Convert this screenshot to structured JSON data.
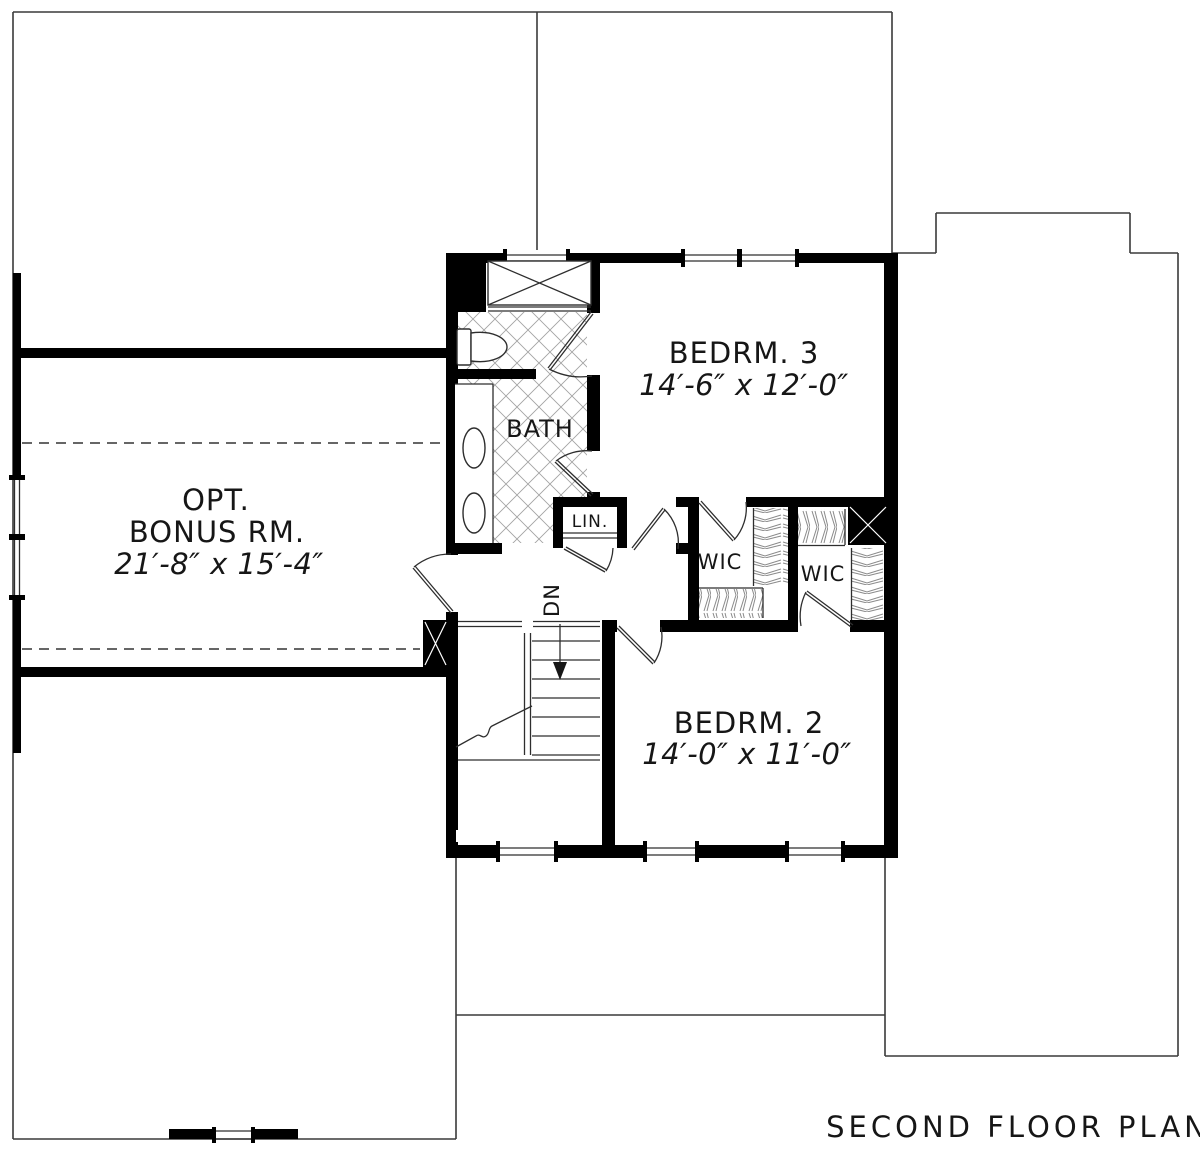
{
  "plan_title": "SECOND FLOOR PLAN",
  "rooms": {
    "bonus": {
      "line1": "OPT.",
      "line2": "BONUS RM.",
      "dims": "21′-8″ x 15′-4″"
    },
    "bedroom3": {
      "name": "BEDRM. 3",
      "dims": "14′-6″ x 12′-0″"
    },
    "bedroom2": {
      "name": "BEDRM. 2",
      "dims": "14′-0″ x 11′-0″"
    },
    "bath": {
      "name": "BATH"
    },
    "linen": {
      "name": "LIN."
    },
    "wic_bedroom3": {
      "name": "WIC"
    },
    "wic_bedroom2": {
      "name": "WIC"
    },
    "stair": {
      "direction_label": "DN"
    }
  },
  "colors": {
    "wall": "#000000",
    "outline": "#3a3a3a",
    "hatch": "#a3a3a3",
    "text": "#161616",
    "background": "#ffffff"
  }
}
